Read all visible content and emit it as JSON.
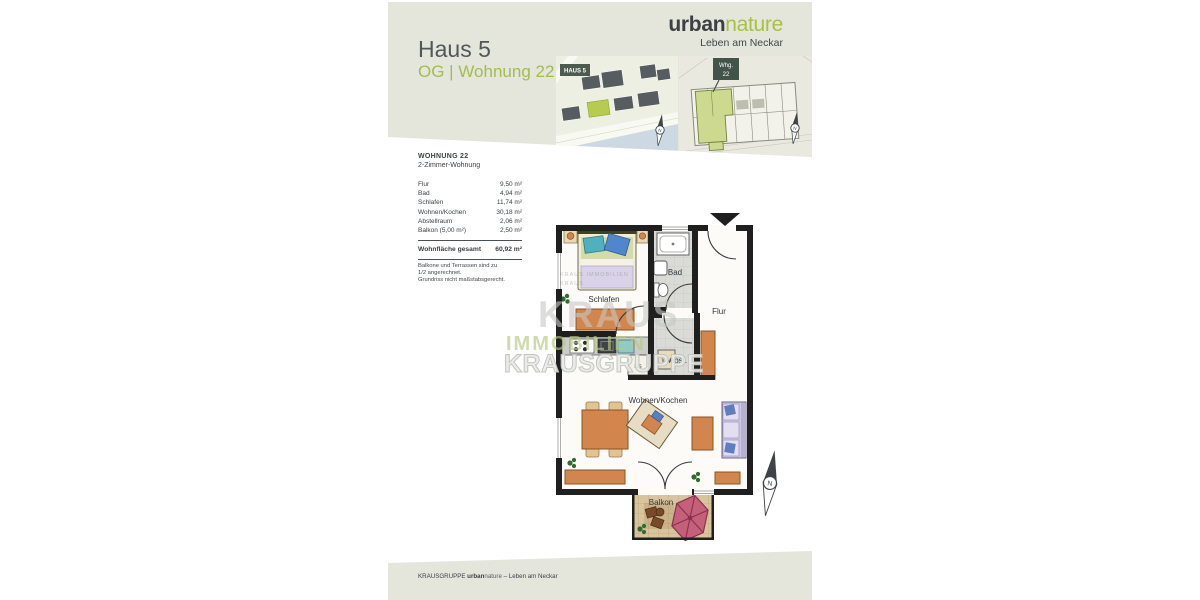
{
  "brand": {
    "logo_bold": "urban",
    "logo_light": "nature",
    "tagline": "Leben am Neckar"
  },
  "header": {
    "title": "Haus 5",
    "subtitle": "OG | Wohnung 22",
    "map1_badge": "HAUS 5",
    "map2_badge_line1": "Whg.",
    "map2_badge_line2": "22",
    "compass_letter": "N"
  },
  "unit": {
    "name": "WOHNUNG 22",
    "type": "2-Zimmer-Wohnung"
  },
  "area_table": {
    "rows": [
      {
        "label": "Flur",
        "value": "9,50 m²"
      },
      {
        "label": "Bad",
        "value": "4,94 m²"
      },
      {
        "label": "Schlafen",
        "value": "11,74 m²"
      },
      {
        "label": "Wohnen/Kochen",
        "value": "30,18 m²"
      },
      {
        "label": "Abstellraum",
        "value": "2,06 m²"
      },
      {
        "label": "Balkon (5,00 m²)",
        "value": "2,50 m²"
      }
    ],
    "total_label": "Wohnfläche gesamt",
    "total_value": "60,92 m²"
  },
  "notes": {
    "line1": "Balkone und Terrassen sind zu",
    "line2": "1/2 angerechnet.",
    "line3": "Grundriss nicht maßstabsgerecht."
  },
  "floorplan": {
    "labels": {
      "schlafen": "Schlafen",
      "bad": "Bad",
      "flur": "Flur",
      "abst": "Abst.",
      "wohnen": "Wohnen/Kochen",
      "balkon": "Balkon"
    },
    "appliances": {
      "ks": "KS",
      "wm": "WM"
    },
    "compass_letter": "N"
  },
  "watermark": {
    "tile": "KRAUS IMMOBILIEN KRAUS",
    "line1": "KRAUS",
    "line2": "IMMOBILIEN",
    "line3": "KRAUSGRUPPE"
  },
  "footer": {
    "company": "KRAUSGRUPPE ",
    "brand_bold": "urban",
    "brand_light": "nature",
    "suffix": " – Leben am Neckar"
  },
  "colors": {
    "accent_green": "#a3bd4a",
    "band": "#e4e5db",
    "highlight_building": "#b7cb4d",
    "wall": "#1f1f1f",
    "furniture_orange": "#d2854c",
    "parasol_pink": "#c4607a",
    "river_blue": "#ccd9e3"
  }
}
